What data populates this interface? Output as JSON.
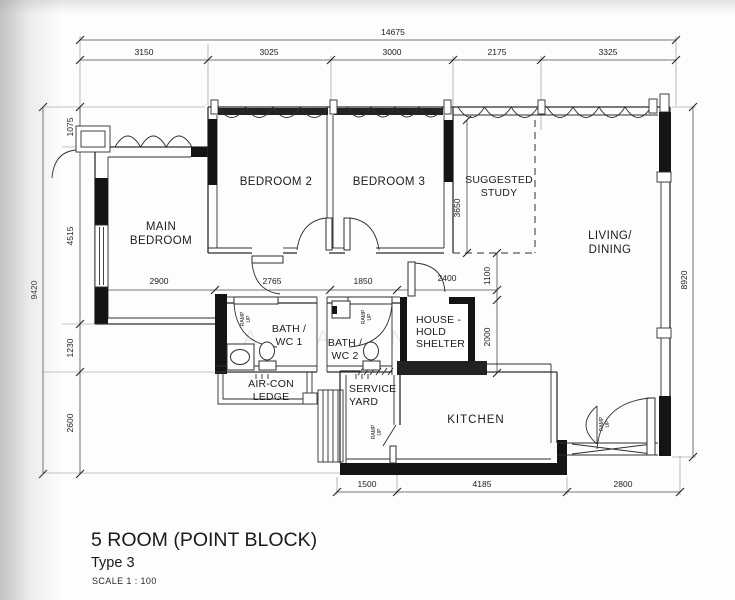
{
  "title": {
    "name": "5 ROOM (POINT BLOCK)",
    "type": "Type 3",
    "scale": "SCALE  1 : 100"
  },
  "rooms": {
    "main_bedroom": {
      "lines": [
        "MAIN",
        "BEDROOM"
      ]
    },
    "bedroom2": {
      "lines": [
        "BEDROOM 2"
      ]
    },
    "bedroom3": {
      "lines": [
        "BEDROOM 3"
      ]
    },
    "suggested_study": {
      "lines": [
        "SUGGESTED",
        "STUDY"
      ]
    },
    "living_dining": {
      "lines": [
        "LIVING/",
        "DINING"
      ]
    },
    "bath_wc1": {
      "lines": [
        "BATH /",
        "WC 1"
      ]
    },
    "bath_wc2": {
      "lines": [
        "BATH /",
        "WC 2"
      ]
    },
    "household_shelter": {
      "lines": [
        "HOUSE -",
        "HOLD",
        "SHELTER"
      ]
    },
    "aircon_ledge": {
      "lines": [
        "AIR-CON",
        "LEDGE"
      ]
    },
    "service_yard": {
      "lines": [
        "SERVICE",
        "YARD"
      ]
    },
    "kitchen": {
      "lines": [
        "KITCHEN"
      ]
    }
  },
  "dimensions": {
    "overall_width": "14675",
    "top_segments": [
      "3150",
      "3025",
      "3000",
      "2175",
      "3325"
    ],
    "left_total": "9420",
    "left_segments": [
      "1075",
      "4515",
      "1230",
      "2600"
    ],
    "right_total": "8920",
    "bottom_segments": [
      "1500",
      "4185",
      "2800"
    ],
    "interior": {
      "main_bedroom_width": "2900",
      "hall_a": "2765",
      "hall_b": "1850",
      "hall_c": "2400",
      "study_depth": "3650",
      "study_to_shelter": "1100",
      "shelter_depth": "2000"
    }
  },
  "annotations": {
    "ramp_up": [
      "RAMP",
      "UP"
    ]
  },
  "watermark": [
    "A",
    "A",
    "N",
    "G"
  ]
}
